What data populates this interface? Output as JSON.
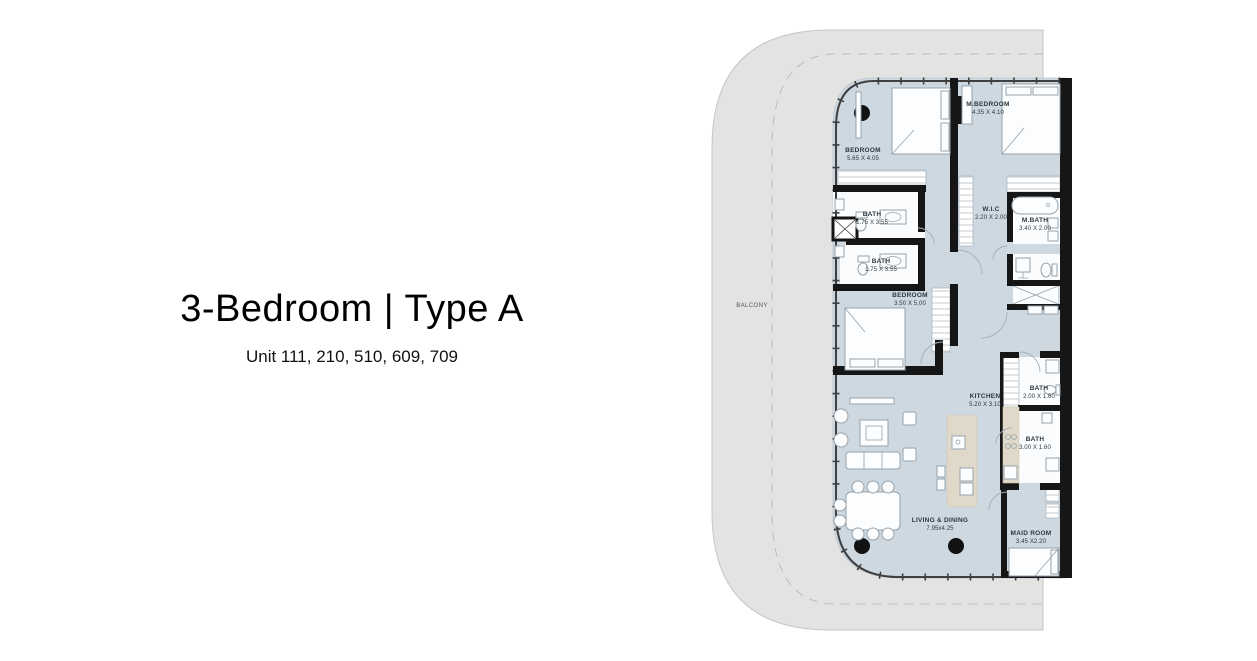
{
  "header": {
    "title": "3-Bedroom | Type A",
    "subtitle": "Unit 111, 210, 510, 609, 709"
  },
  "floorplan": {
    "balcony_label": "BALCONY",
    "rooms": [
      {
        "name": "BEDROOM",
        "dims": "5.65 X 4.05"
      },
      {
        "name": "M.BEDROOM",
        "dims": "4.35 X 4.10"
      },
      {
        "name": "BATH",
        "dims": "1.75 X 3.55"
      },
      {
        "name": "W.I.C",
        "dims": "2.20 X 2.00"
      },
      {
        "name": "M.BATH",
        "dims": "3.40 X 2.00"
      },
      {
        "name": "BATH",
        "dims": "1.75 X 3.55"
      },
      {
        "name": "BEDROOM",
        "dims": "3.50 X 5.00"
      },
      {
        "name": "KITCHEN",
        "dims": "5.20 X 3.10"
      },
      {
        "name": "BATH",
        "dims": "2.00 X 1.60"
      },
      {
        "name": "BATH",
        "dims": "3.00 X 1.60"
      },
      {
        "name": "LIVING & DINING",
        "dims": "7.95x4.25"
      },
      {
        "name": "MAID ROOM",
        "dims": "3.45 X2.20"
      }
    ],
    "colors": {
      "floor": "#cdd8e1",
      "balcony": "#e3e3e1",
      "wall": "#161616",
      "counter": "#e0d9c9",
      "label_text": "#2d3840"
    }
  }
}
